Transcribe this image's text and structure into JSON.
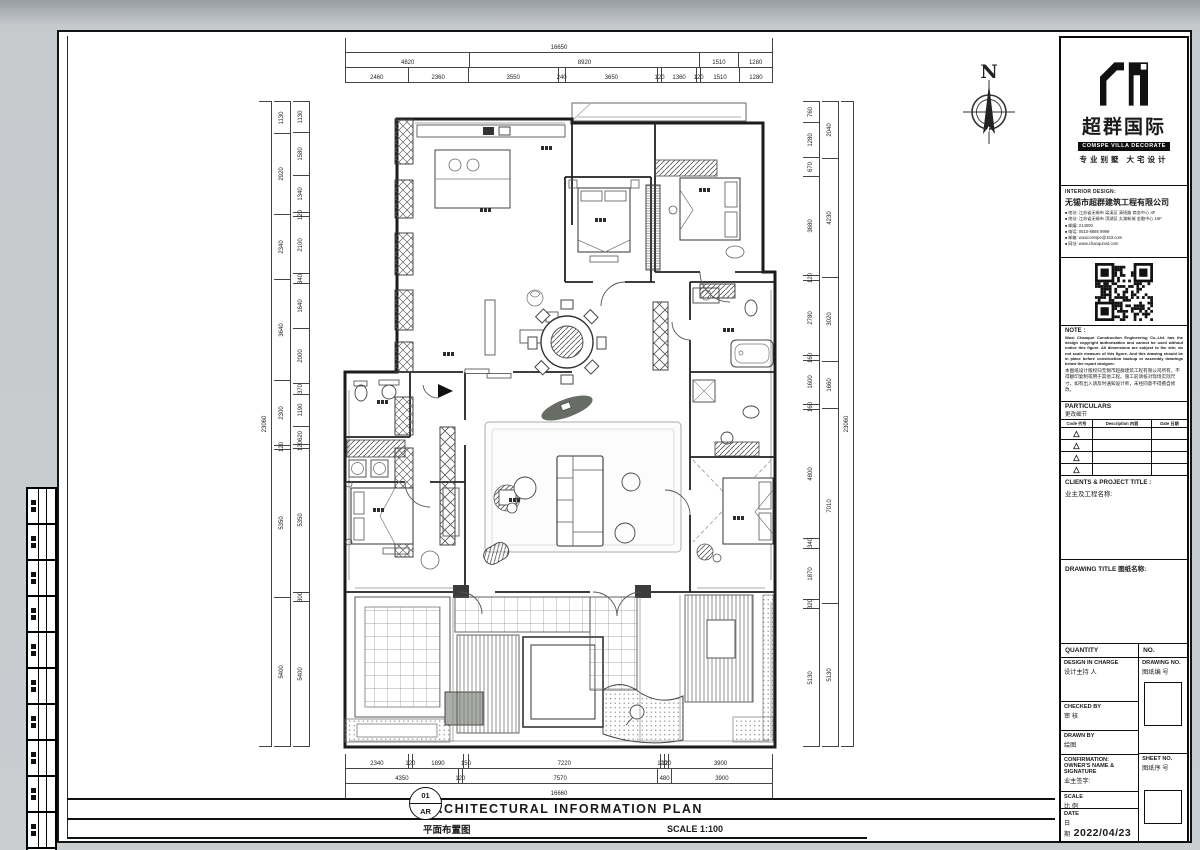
{
  "logo": {
    "cn": "超群国际",
    "en": "COMSPE VILLA DECORATE",
    "tagline": "专业别墅 大宅设计"
  },
  "interior_design": {
    "heading": "INTERIOR DESIGN:",
    "company": "无锡市超群建筑工程有限公司",
    "lines": [
      "地址: 江苏省无锡市 梁溪区 清扬路 商务中心 4F",
      "地址: 江苏省无锡市 滨湖区 太湖新城 金融中心 16F",
      "邮编: 214000",
      "电话: 0510-8866 9999",
      "邮箱: wuxicomspe@163.com",
      "网址: www.chaoqunvd.com"
    ]
  },
  "note": {
    "heading": "NOTE :",
    "en": "Wuxi Chaoqun Construction Engineering Co.,Ltd. has the design copyright authorization and cannot be used without notice this figure. All dimensions are subject to the site; do not scale measure of this figure. And this drawing should be in place before construction backup or assembly drawings below the report designer.",
    "cn": "本图纸设计版权归无锡市超群建筑工程有限公司所有，不得翻印复制或用于其他工程。施工前请核对现场实际尺寸，如有出入请及时通知设计师，未经同意不得擅自修改。"
  },
  "particulars": {
    "heading": "PARTICULARS",
    "sub": "更改细节",
    "headers": [
      "Code 代号",
      "Description 内容",
      "Date 日期"
    ],
    "row_count": 4,
    "revision_mark": "△"
  },
  "clients": {
    "heading": "CLIENTS & PROJECT TITLE :",
    "sub": "业主及工程名称:"
  },
  "drawing_title_block": {
    "heading": "DRAWING TITLE 图纸名称:"
  },
  "quantity": {
    "label": "QUANTITY",
    "no_label": "NO."
  },
  "design_in_charge": {
    "en": "DESIGN IN CHARGE",
    "cn": "设计主持 人"
  },
  "drawing_no": {
    "en": "DRAWING NO.",
    "cn": "图纸编 号"
  },
  "checked_by": {
    "en": "CHECKED BY",
    "cn": "审 核"
  },
  "drawn_by": {
    "en": "DRAWN BY",
    "cn": "绘图"
  },
  "confirmation": {
    "en": "CONFIRMATION:",
    "en2": "OWNER'S NAME & SIGNATURE",
    "cn": "业主签字:"
  },
  "sheet_no": {
    "en": "SHEET NO.",
    "cn": "图纸序 号"
  },
  "scale_block": {
    "en": "SCALE",
    "cn": "比 例"
  },
  "date_block": {
    "en": "DATE",
    "cn": "日期",
    "value": "2022/04/23"
  },
  "north_label": "N",
  "plan_caption": {
    "number": "01",
    "code": "AR",
    "title_en": "ARCHITECTURAL INFORMATION PLAN",
    "title_cn": "平面布置图",
    "scale": "SCALE 1:100"
  },
  "dimensions": {
    "top": {
      "total": [
        16650
      ],
      "mid": [
        4820,
        8920,
        1510,
        1280
      ],
      "detail": [
        2460,
        2360,
        3550,
        240,
        3650,
        120,
        1360,
        120,
        1510,
        1280
      ]
    },
    "bottom": {
      "detail": [
        2340,
        120,
        1890,
        150,
        7220,
        120,
        120,
        3900
      ],
      "mid": [
        4350,
        120,
        7570,
        480,
        3900
      ],
      "total": [
        16660
      ]
    },
    "left": {
      "total": [
        23060
      ],
      "outer": [
        1130,
        2920,
        2340,
        3640,
        2300,
        120,
        5350,
        5400
      ],
      "inner": [
        1130,
        1580,
        1340,
        120,
        2100,
        340,
        1640,
        2000,
        370,
        1190,
        620,
        120,
        5350,
        300,
        5400
      ]
    },
    "right": {
      "inner": [
        760,
        1280,
        670,
        3680,
        120,
        2780,
        160,
        1600,
        160,
        4800,
        340,
        1870,
        320,
        5130
      ],
      "outer": [
        2040,
        4230,
        3020,
        1660,
        7010,
        5130
      ],
      "total": [
        23060
      ]
    }
  },
  "left_strip": {
    "row_count": 10
  }
}
